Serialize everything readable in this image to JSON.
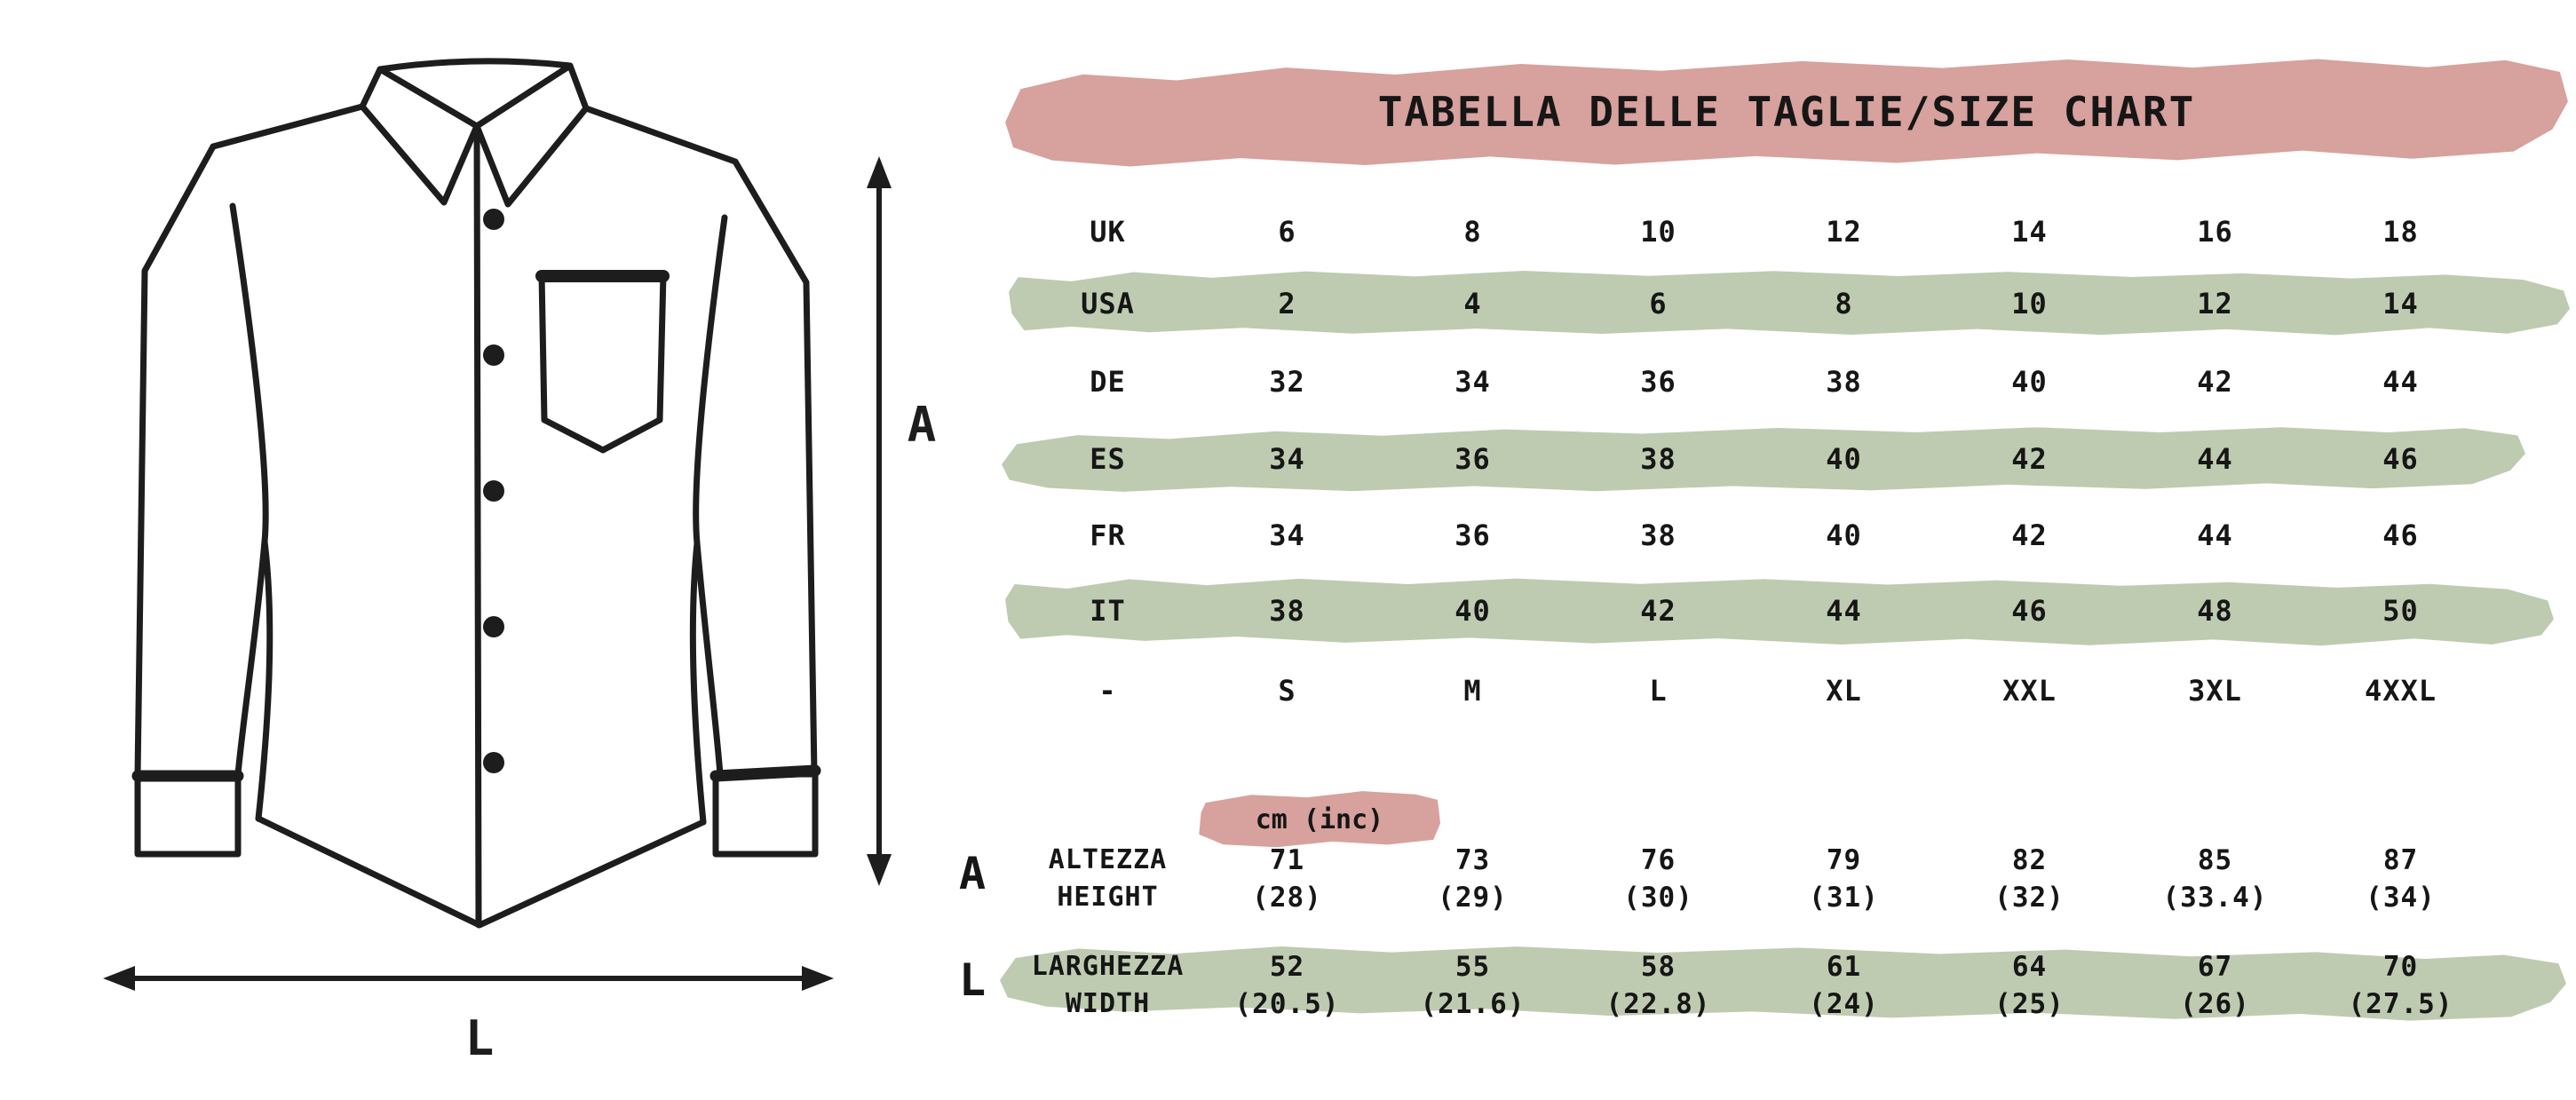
{
  "title": "TABELLA DELLE TAGLIE/SIZE CHART",
  "colors": {
    "pink": "#d7a19d",
    "green": "#becbb0",
    "ink": "#1d1d1d"
  },
  "diagram": {
    "height_arrow_label": "A",
    "width_arrow_label": "L"
  },
  "size_table": {
    "rows": [
      {
        "label": "UK",
        "highlight": false,
        "values": [
          "6",
          "8",
          "10",
          "12",
          "14",
          "16",
          "18"
        ]
      },
      {
        "label": "USA",
        "highlight": true,
        "values": [
          "2",
          "4",
          "6",
          "8",
          "10",
          "12",
          "14"
        ]
      },
      {
        "label": "DE",
        "highlight": false,
        "values": [
          "32",
          "34",
          "36",
          "38",
          "40",
          "42",
          "44"
        ]
      },
      {
        "label": "ES",
        "highlight": true,
        "values": [
          "34",
          "36",
          "38",
          "40",
          "42",
          "44",
          "46"
        ]
      },
      {
        "label": "FR",
        "highlight": false,
        "values": [
          "34",
          "36",
          "38",
          "40",
          "42",
          "44",
          "46"
        ]
      },
      {
        "label": "IT",
        "highlight": true,
        "values": [
          "38",
          "40",
          "42",
          "44",
          "46",
          "48",
          "50"
        ]
      },
      {
        "label": "-",
        "highlight": false,
        "values": [
          "S",
          "M",
          "L",
          "XL",
          "XXL",
          "3XL",
          "4XXL"
        ]
      }
    ]
  },
  "measurements": {
    "unit_label": "cm (inc)",
    "height": {
      "row_letter": "A",
      "label_it": "ALTEZZA",
      "label_en": "HEIGHT",
      "cm": [
        "71",
        "73",
        "76",
        "79",
        "82",
        "85",
        "87"
      ],
      "inches": [
        "(28)",
        "(29)",
        "(30)",
        "(31)",
        "(32)",
        "(33.4)",
        "(34)"
      ]
    },
    "width": {
      "row_letter": "L",
      "label_it": "LARGHEZZA",
      "label_en": "WIDTH",
      "cm": [
        "52",
        "55",
        "58",
        "61",
        "64",
        "67",
        "70"
      ],
      "inches": [
        "(20.5)",
        "(21.6)",
        "(22.8)",
        "(24)",
        "(25)",
        "(26)",
        "(27.5)"
      ]
    }
  }
}
